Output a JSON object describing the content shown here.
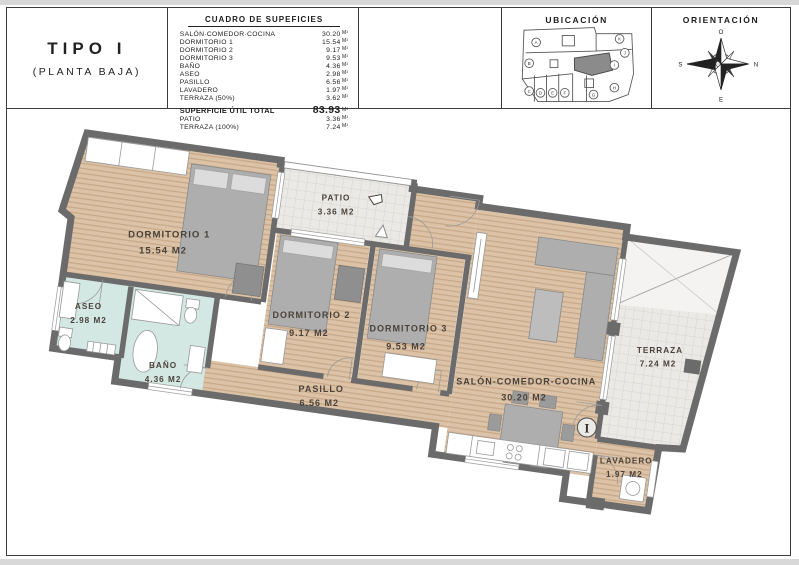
{
  "title_block": {
    "type_label": "TIPO I",
    "floor_label": "(PLANTA BAJA)"
  },
  "areas_table": {
    "title": "CUADRO DE SUPEFICIES",
    "unit": "m²",
    "rows": [
      {
        "label": "SALÓN·COMEDOR·COCINA",
        "value": "30.20"
      },
      {
        "label": "DORMITORIO 1",
        "value": "15.54"
      },
      {
        "label": "DORMITORIO 2",
        "value": "9.17"
      },
      {
        "label": "DORMITORIO 3",
        "value": "9.53"
      },
      {
        "label": "BAÑO",
        "value": "4.36"
      },
      {
        "label": "ASEO",
        "value": "2.98"
      },
      {
        "label": "PASILLO",
        "value": "6.56"
      },
      {
        "label": "LAVADERO",
        "value": "1.97"
      },
      {
        "label": "TERRAZA (50%)",
        "value": "3.62"
      }
    ],
    "total": {
      "label": "SUPERFICIE ÚTIL TOTAL",
      "value": "83.93"
    },
    "extra_rows": [
      {
        "label": "PATIO",
        "value": "3.36"
      },
      {
        "label": "TERRAZA (100%)",
        "value": "7.24"
      }
    ]
  },
  "ubicacion": {
    "title": "UBICACIÓN",
    "highlighted_unit": "I",
    "unit_letters": [
      "A",
      "B",
      "C",
      "D",
      "E",
      "F",
      "G",
      "H",
      "I",
      "J",
      "K"
    ]
  },
  "orientacion": {
    "title": "ORIENTACIÓN",
    "compass": {
      "top": "O",
      "right": "N",
      "bottom": "E",
      "left": "S"
    }
  },
  "floor_plan": {
    "unit_mark": "I",
    "colors": {
      "wood": "#dcc3a7",
      "wood_stripe": "#c8a989",
      "wet_room": "#d3e7e3",
      "tile": "#eae9e5",
      "wall": "#6b6b6b",
      "label_text": "#4a423a"
    },
    "rooms": [
      {
        "id": "dormitorio-1",
        "label": "DORMITORIO 1",
        "area": "15.54 m2"
      },
      {
        "id": "patio",
        "label": "PATIO",
        "area": "3.36 m2"
      },
      {
        "id": "aseo",
        "label": "ASEO",
        "area": "2.98 m2"
      },
      {
        "id": "bano",
        "label": "BAÑO",
        "area": "4.36 m2"
      },
      {
        "id": "dormitorio-2",
        "label": "DORMITORIO 2",
        "area": "9.17 m2"
      },
      {
        "id": "dormitorio-3",
        "label": "DORMITORIO 3",
        "area": "9.53 m2"
      },
      {
        "id": "pasillo",
        "label": "PASILLO",
        "area": "6.56 m2"
      },
      {
        "id": "salon",
        "label": "SALÓN-COMEDOR-COCINA",
        "area": "30.20 m2"
      },
      {
        "id": "terraza",
        "label": "TERRAZA",
        "area": "7.24 m2"
      },
      {
        "id": "lavadero",
        "label": "LAVADERO",
        "area": "1.97 m2"
      }
    ]
  }
}
